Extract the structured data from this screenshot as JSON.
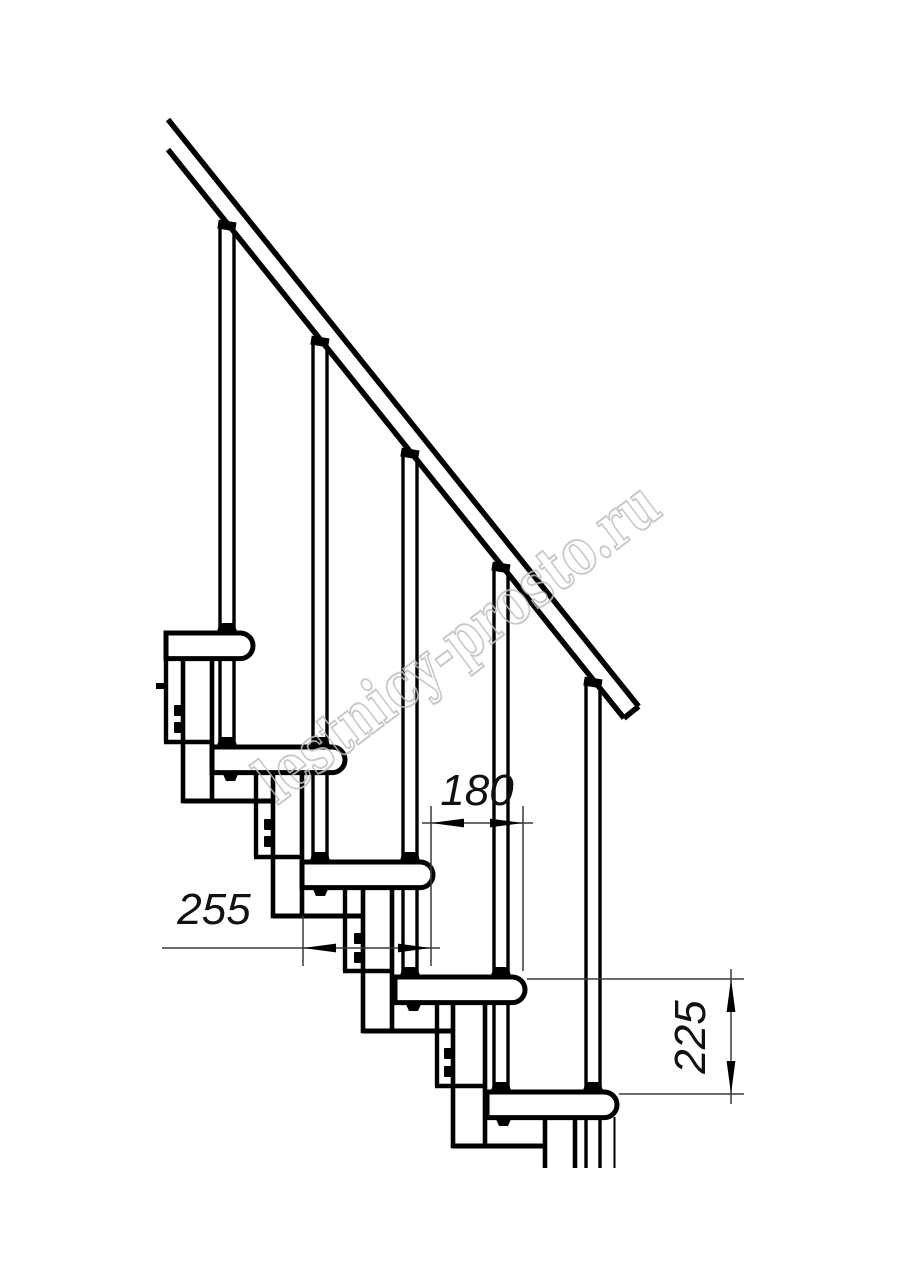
{
  "drawing": {
    "type_label": "staircase-side-elevation",
    "colors": {
      "line": "#000000",
      "background": "#ffffff",
      "dimension_line": "#3a3a3a",
      "watermark": "#bfbfbf"
    },
    "dimensions": {
      "step_run": {
        "value": "180"
      },
      "tread_depth": {
        "value": "255"
      },
      "step_height": {
        "value": "225"
      }
    },
    "watermark": {
      "text": "lestnicy-prosto.ru"
    }
  }
}
